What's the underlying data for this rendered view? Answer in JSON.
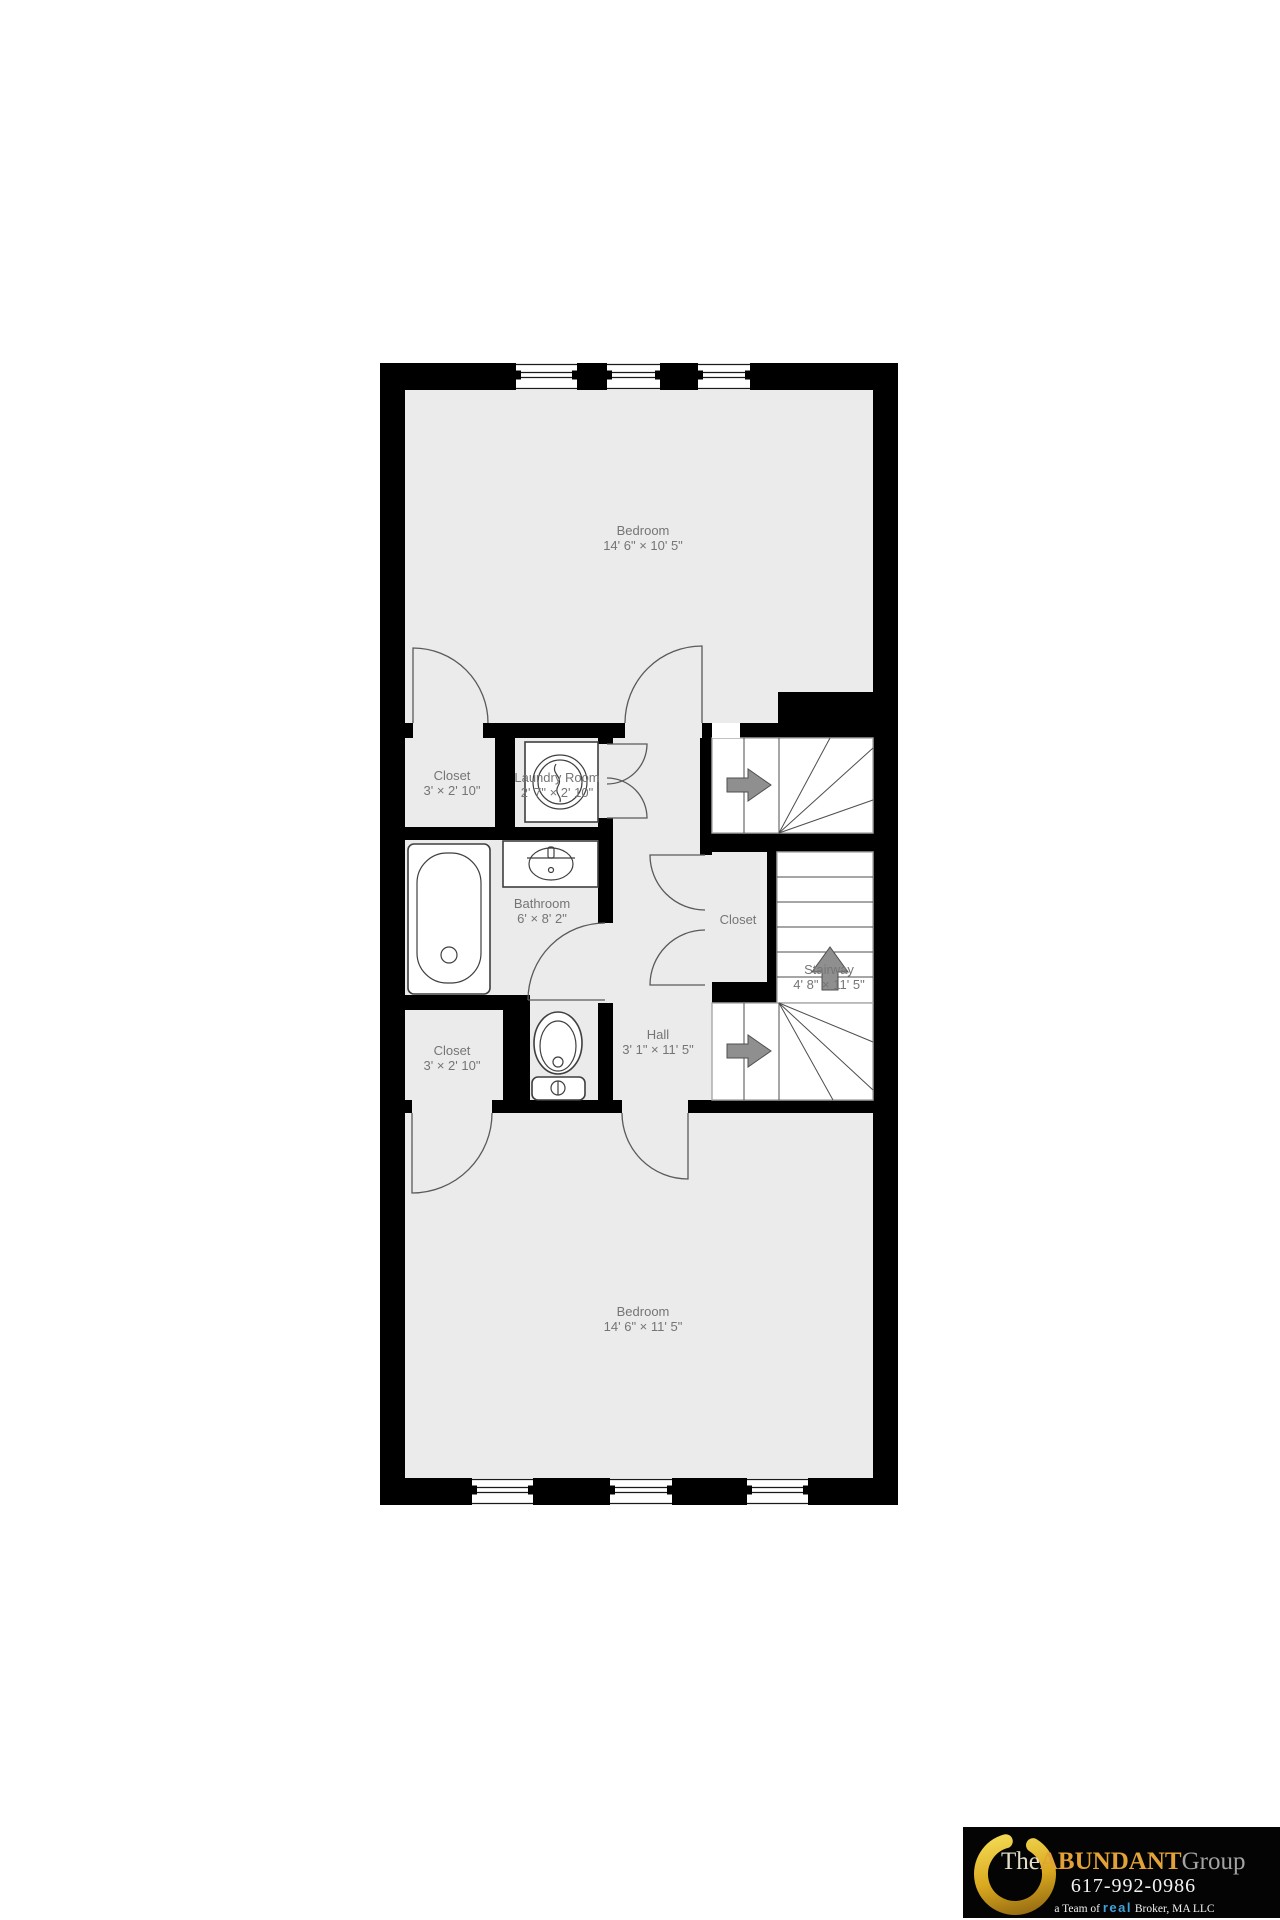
{
  "floor_plan": {
    "rooms": [
      {
        "name": "Bedroom",
        "dims": "14' 6\" × 10' 5\""
      },
      {
        "name": "Closet",
        "dims": "3' × 2' 10\""
      },
      {
        "name": "Laundry Room",
        "dims": "2' 7\" × 2' 10\""
      },
      {
        "name": "Bathroom",
        "dims": "6' × 8' 2\""
      },
      {
        "name": "Closet",
        "dims": ""
      },
      {
        "name": "Stairway",
        "dims": "4' 8\" × 11' 5\""
      },
      {
        "name": "Hall",
        "dims": "3' 1\" × 11' 5\""
      },
      {
        "name": "Closet",
        "dims": "3' × 2' 10\""
      },
      {
        "name": "Bedroom",
        "dims": "14' 6\" × 11' 5\""
      }
    ],
    "colors": {
      "wall": "#000000",
      "floor": "#ebebeb",
      "stairs": "#ffffff",
      "label_text": "#757575"
    }
  },
  "logo": {
    "brand_the": "The",
    "brand_abundant": "ABUNDANT",
    "brand_group": "Group",
    "phone": "617-992-0986",
    "team_prefix": "a Team of",
    "team_brand": "real",
    "team_suffix": "Broker, MA LLC",
    "colors": {
      "background": "#000000",
      "gold": "#e2a237",
      "real_blue": "#3fa2da"
    }
  }
}
